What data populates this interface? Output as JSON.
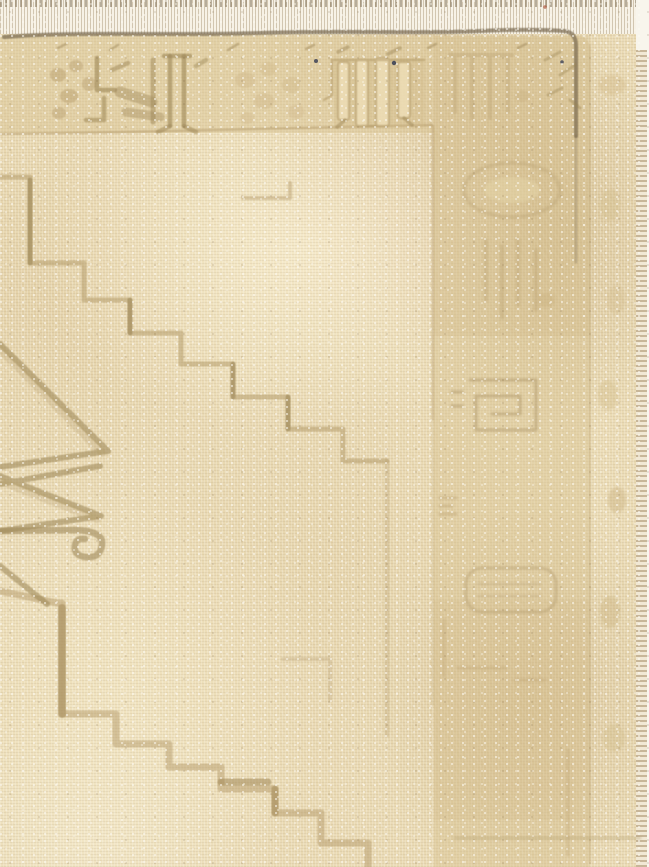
{
  "image": {
    "subject": "Close-up photograph of a faded vintage hand-knotted wool rug, corner fragment",
    "style": "Muted cream, beige and tan palette; geometric stepped motifs; heavily worn pile",
    "width_px": 649,
    "height_px": 867
  },
  "palette": {
    "field_base": "#e9d9b2",
    "field_light": "#f4e9ca",
    "field_shadow": "#dcc79c",
    "border_band": "#d7c190",
    "border_band_dark": "#c6ab7a",
    "outer_strip": "#e8d9b0",
    "selvedge": "#f1e8d4",
    "fringe_white": "#f7f2e6",
    "edge_line": "#77684e",
    "motif_olive": "#9a8453",
    "motif_tan": "#b59c6b",
    "motif_faint": "#c8b285",
    "navy_fleck": "#3d4257",
    "red_fleck": "#b05a42",
    "white_fleck": "#fdfaf2"
  },
  "scene": {
    "rug_label": "faded vintage rug corner photograph",
    "top_fringe": {
      "label": "woven top edge with fringe stitching"
    },
    "top_edge_line": {
      "label": "dark selvedge line along top edge turning down at corner"
    },
    "top_border": {
      "label": "upper border band with faded geometric motifs",
      "motifs": [
        "hooked motif with double bars",
        "rosette blossom cluster",
        "light barred motif with ghost outline",
        "faded bar motif near corner",
        "corner tick marks"
      ]
    },
    "right_border": {
      "label": "right border band with nearly worn-away motifs",
      "motifs": [
        "arched oval outline",
        "vertical bar cluster",
        "rectangular key meander",
        "small double dashes",
        "rounded cartouche with inner lines",
        "faint bottom rule"
      ]
    },
    "outer_guard": {
      "label": "outer guard stripe with faded leaf blobs"
    },
    "selvedge": {
      "label": "overcast selvedge edge at right"
    },
    "field": {
      "label": "open cream field",
      "elements": [
        "upper stepped diagonal line",
        "long fading vertical tail",
        "step fragment above staircase",
        "faint step fragment lower middle",
        "lower stepped diagonal line to bottom edge",
        "serrated medallion chevrons at left edge",
        "smooth band ending in scroll hook curl",
        "lower serrated diagonal"
      ]
    },
    "flecks": {
      "label": "tiny dark knot flecks",
      "positions": [
        "316,61",
        "394,63",
        "562,62"
      ]
    }
  }
}
